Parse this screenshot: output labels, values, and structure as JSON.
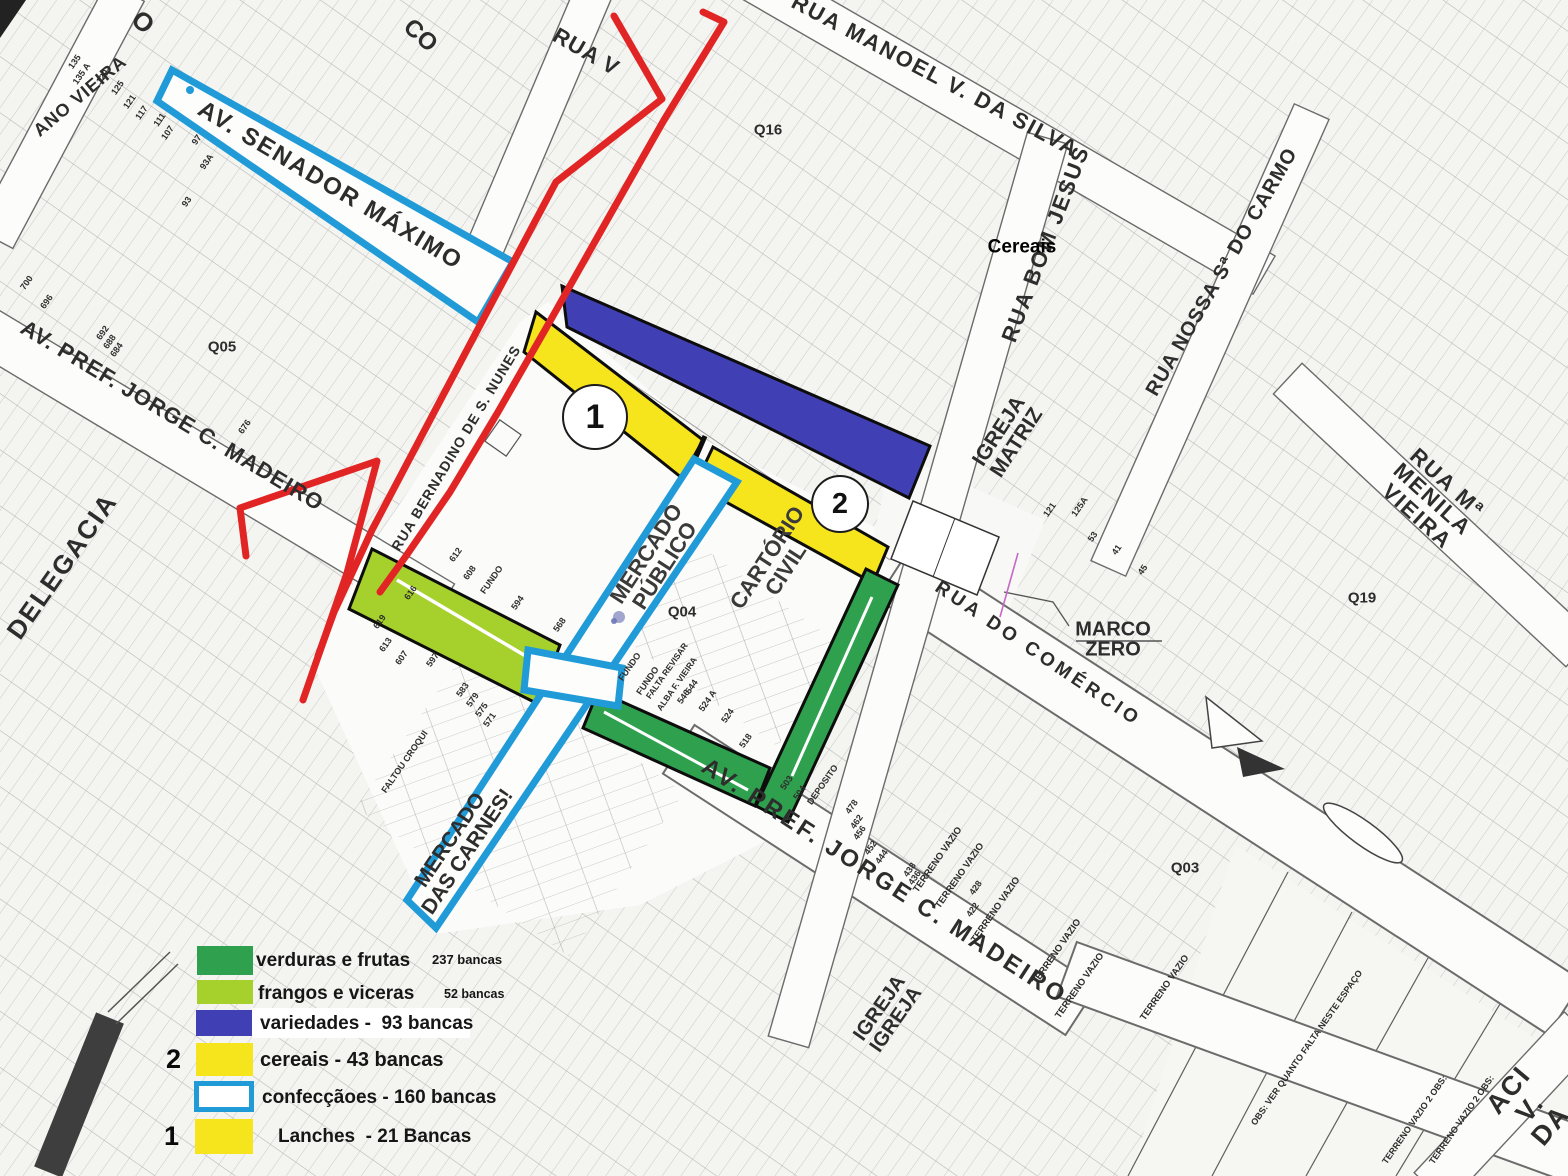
{
  "colors": {
    "green": "#2fa04e",
    "light_green": "#a6d02c",
    "blue": "#4040b4",
    "yellow": "#f6e41d",
    "cyan": "#209bd8",
    "red": "#e12525",
    "magenta": "#c667c6",
    "paper": "#f4f4f1",
    "street": "#fcfcfa",
    "ink": "#2d2d2d",
    "dark_bar": "#3e3e3e"
  },
  "legend": {
    "marker_2": "2",
    "marker_1": "1",
    "items": [
      {
        "label": "verduras e frutas",
        "count": "237 bancas"
      },
      {
        "label": "frangos e viceras",
        "count": "52 bancas"
      },
      {
        "label": "variedades -  93 bancas",
        "count": ""
      },
      {
        "label": "cereais - 43 bancas",
        "count": ""
      },
      {
        "label": "confecçãoes - 160 bancas",
        "count": ""
      },
      {
        "label": "Lanches  - 21 Bancas",
        "count": ""
      }
    ]
  },
  "map": {
    "markers": {
      "circle_1": "1",
      "circle_2": "2"
    },
    "street_labels": [
      {
        "name": "street-label-senador-maximo",
        "t": "AV. SENADOR MÁXIMO",
        "x": 330,
        "y": 186,
        "rot": 31,
        "size": 24,
        "ls": 2
      },
      {
        "name": "street-label-manoel-silva",
        "t": "RUA MANOEL V. DA SILVA",
        "x": 935,
        "y": 76,
        "rot": 28,
        "size": 22,
        "ls": 2
      },
      {
        "name": "street-label-madeiro-upper",
        "t": "AV. PREF. JORGE C. MADEIRO",
        "x": 172,
        "y": 416,
        "rot": 31,
        "size": 22,
        "ls": 1
      },
      {
        "name": "street-label-bernardino",
        "t": "RUA BERNADINO DE S. NUNES",
        "x": 456,
        "y": 448,
        "rot": -59,
        "size": 14,
        "ls": 1
      },
      {
        "name": "street-label-bom-jesus",
        "t": "RUA BOM JESUS",
        "x": 1046,
        "y": 244,
        "rot": -69,
        "size": 22,
        "ls": 2
      },
      {
        "name": "street-label-carmo",
        "t": "RUA NOSSA Sª DO CARMO",
        "x": 1222,
        "y": 272,
        "rot": -60,
        "size": 20,
        "ls": 1
      },
      {
        "name": "street-label-menila-vieira",
        "t": "RUA Mª MENILA VIEIRA",
        "x": 1432,
        "y": 500,
        "rot": 42,
        "size": 22,
        "ls": 2
      },
      {
        "name": "street-label-comercio",
        "t": "RUA DO COMÉRCIO",
        "x": 1038,
        "y": 654,
        "rot": 34,
        "size": 19,
        "ls": 4
      },
      {
        "name": "street-label-madeiro-lower",
        "t": "AV. PREF. JORGE C. MADEIRO",
        "x": 884,
        "y": 882,
        "rot": 33,
        "size": 24,
        "ls": 3
      },
      {
        "name": "street-label-aci",
        "t": "ACI V. DA",
        "x": 1530,
        "y": 1108,
        "rot": -50,
        "size": 27,
        "ls": 2
      },
      {
        "name": "street-label-rua-v",
        "t": "RUA V",
        "x": 586,
        "y": 52,
        "rot": 30,
        "size": 22,
        "ls": 1
      },
      {
        "name": "street-label-ano-vieira",
        "t": "ANO VIEIRA",
        "x": 80,
        "y": 96,
        "rot": -40,
        "size": 18,
        "ls": 1
      },
      {
        "name": "street-label-co",
        "t": "CO",
        "x": 420,
        "y": 36,
        "rot": 42,
        "size": 24
      },
      {
        "name": "street-label-o-fragment",
        "t": "O",
        "x": 143,
        "y": 22,
        "rot": 42,
        "size": 26
      }
    ],
    "area_labels": [
      {
        "name": "area-label-delegacia",
        "t": "DELEGACIA",
        "x": 62,
        "y": 566,
        "rot": -55,
        "size": 26,
        "ls": 2
      },
      {
        "name": "area-label-igreja-matriz",
        "t": "IGREJA\nMATRIZ",
        "x": 1008,
        "y": 437,
        "rot": -57,
        "size": 21
      },
      {
        "name": "area-label-mercado-publico",
        "t": "MERCADO\nPÚBLICO",
        "x": 656,
        "y": 560,
        "rot": -57,
        "size": 22,
        "color": "#3a3a3a"
      },
      {
        "name": "area-label-cartorio-civil",
        "t": "CARTÓRIO\nCIVIL",
        "x": 777,
        "y": 564,
        "rot": -57,
        "size": 22,
        "color": "#3a3a3a"
      },
      {
        "name": "area-label-mercado-carnes",
        "t": "MERCADO\nDAS CARNES!",
        "x": 459,
        "y": 846,
        "rot": -56,
        "size": 21
      },
      {
        "name": "area-label-marco-zero",
        "t": "MARCO\nZERO",
        "x": 1113,
        "y": 640,
        "rot": 0,
        "size": 20
      },
      {
        "name": "area-label-igreja-igreja",
        "t": "IGREJA\nIGREJA",
        "x": 888,
        "y": 1014,
        "rot": -55,
        "size": 20
      },
      {
        "name": "area-label-cereais",
        "t": "Cereais",
        "x": 1022,
        "y": 247,
        "rot": 0,
        "size": 19,
        "color": "#000"
      }
    ],
    "quad_labels": [
      {
        "name": "quad-label-q05",
        "t": "Q05",
        "x": 222,
        "y": 347
      },
      {
        "name": "quad-label-q16",
        "t": "Q16",
        "x": 768,
        "y": 130
      },
      {
        "name": "quad-label-q04",
        "t": "Q04",
        "x": 682,
        "y": 612
      },
      {
        "name": "quad-label-q19",
        "t": "Q19",
        "x": 1362,
        "y": 598
      },
      {
        "name": "quad-label-q03",
        "t": "Q03",
        "x": 1185,
        "y": 868
      }
    ],
    "small_labels": [
      {
        "name": "note-terreno-vazio",
        "t": "TERRENO VAZIO",
        "x": 938,
        "y": 860,
        "rot": -55,
        "size": 9.5
      },
      {
        "name": "note-terreno-vazio",
        "t": "TERRENO VAZIO",
        "x": 960,
        "y": 876,
        "rot": -55,
        "size": 9.5
      },
      {
        "name": "note-terreno-vazio",
        "t": "TERRENO VAZIO",
        "x": 996,
        "y": 910,
        "rot": -55,
        "size": 9.5
      },
      {
        "name": "note-terreno-vazio",
        "t": "TERRENO VAZIO",
        "x": 1057,
        "y": 952,
        "rot": -55,
        "size": 9.5
      },
      {
        "name": "note-terreno-vazio",
        "t": "TERRENO VAZIO",
        "x": 1080,
        "y": 986,
        "rot": -55,
        "size": 9.5
      },
      {
        "name": "note-terreno-vazio",
        "t": "TERRENO VAZIO",
        "x": 1165,
        "y": 988,
        "rot": -55,
        "size": 9.5
      },
      {
        "name": "note-terreno-vazio-obs",
        "t": "TERRENO VAZIO 2 OBS:",
        "x": 1415,
        "y": 1120,
        "rot": -55,
        "size": 9
      },
      {
        "name": "note-terreno-vazio-obs",
        "t": "TERRENO VAZIO 2 OBS:",
        "x": 1462,
        "y": 1120,
        "rot": -55,
        "size": 9
      },
      {
        "name": "note-obs-espaco",
        "t": "OBS: VER QUANTO FALTA NESTE ESPAÇO",
        "x": 1307,
        "y": 1048,
        "rot": -55,
        "size": 9
      },
      {
        "name": "note-fundo",
        "t": "FUNDO",
        "x": 492,
        "y": 580,
        "rot": -55,
        "size": 9
      },
      {
        "name": "note-fundo",
        "t": "FUNDO",
        "x": 630,
        "y": 667,
        "rot": -55,
        "size": 9
      },
      {
        "name": "note-fundo",
        "t": "FUNDO",
        "x": 648,
        "y": 681,
        "rot": -55,
        "size": 9
      },
      {
        "name": "note-falta-revisar",
        "t": "FALTA REVISAR",
        "x": 667,
        "y": 671,
        "rot": -55,
        "size": 8.5
      },
      {
        "name": "note-alba-vieira",
        "t": "ALBA F. VIEIRA",
        "x": 677,
        "y": 684,
        "rot": -55,
        "size": 8.5
      },
      {
        "name": "note-faltou-croqui",
        "t": "FALTOU CROQUI",
        "x": 405,
        "y": 762,
        "rot": -55,
        "size": 9
      },
      {
        "name": "note-deposito",
        "t": "DEPOSITO",
        "x": 823,
        "y": 785,
        "rot": -55,
        "size": 9
      }
    ],
    "parcel_numbers": [
      {
        "t": "135",
        "x": 75,
        "y": 62
      },
      {
        "t": "135 A",
        "x": 82,
        "y": 74
      },
      {
        "t": "129",
        "x": 103,
        "y": 77
      },
      {
        "t": "125",
        "x": 118,
        "y": 88
      },
      {
        "t": "121",
        "x": 130,
        "y": 102
      },
      {
        "t": "117",
        "x": 142,
        "y": 113
      },
      {
        "t": "111",
        "x": 160,
        "y": 120
      },
      {
        "t": "107",
        "x": 168,
        "y": 133
      },
      {
        "t": "97",
        "x": 197,
        "y": 140
      },
      {
        "t": "93A",
        "x": 207,
        "y": 162
      },
      {
        "t": "93",
        "x": 187,
        "y": 202
      },
      {
        "t": "700",
        "x": 27,
        "y": 283
      },
      {
        "t": "696",
        "x": 47,
        "y": 302
      },
      {
        "t": "692",
        "x": 103,
        "y": 333
      },
      {
        "t": "688",
        "x": 110,
        "y": 342
      },
      {
        "t": "684",
        "x": 117,
        "y": 350
      },
      {
        "t": "676",
        "x": 245,
        "y": 427
      },
      {
        "t": "619",
        "x": 380,
        "y": 622
      },
      {
        "t": "613",
        "x": 386,
        "y": 645
      },
      {
        "t": "607",
        "x": 402,
        "y": 658
      },
      {
        "t": "597",
        "x": 433,
        "y": 660
      },
      {
        "t": "583",
        "x": 463,
        "y": 690
      },
      {
        "t": "579",
        "x": 473,
        "y": 700
      },
      {
        "t": "575",
        "x": 482,
        "y": 710
      },
      {
        "t": "571",
        "x": 490,
        "y": 720
      },
      {
        "t": "616",
        "x": 411,
        "y": 593
      },
      {
        "t": "612",
        "x": 456,
        "y": 555
      },
      {
        "t": "608",
        "x": 470,
        "y": 573
      },
      {
        "t": "594",
        "x": 518,
        "y": 603
      },
      {
        "t": "568",
        "x": 560,
        "y": 625
      },
      {
        "t": "544",
        "x": 692,
        "y": 687
      },
      {
        "t": "546",
        "x": 684,
        "y": 697
      },
      {
        "t": "524 A",
        "x": 708,
        "y": 701
      },
      {
        "t": "524",
        "x": 728,
        "y": 716
      },
      {
        "t": "518",
        "x": 746,
        "y": 741
      },
      {
        "t": "503",
        "x": 787,
        "y": 783
      },
      {
        "t": "504",
        "x": 800,
        "y": 793
      },
      {
        "t": "478",
        "x": 852,
        "y": 807
      },
      {
        "t": "462",
        "x": 857,
        "y": 822
      },
      {
        "t": "456",
        "x": 860,
        "y": 833
      },
      {
        "t": "452",
        "x": 871,
        "y": 848
      },
      {
        "t": "444",
        "x": 882,
        "y": 857
      },
      {
        "t": "438",
        "x": 910,
        "y": 870
      },
      {
        "t": "436",
        "x": 915,
        "y": 878
      },
      {
        "t": "428",
        "x": 976,
        "y": 888
      },
      {
        "t": "422",
        "x": 973,
        "y": 910
      },
      {
        "t": "121",
        "x": 1050,
        "y": 510
      },
      {
        "t": "125A",
        "x": 1080,
        "y": 507
      },
      {
        "t": "53",
        "x": 1093,
        "y": 537
      },
      {
        "t": "41",
        "x": 1117,
        "y": 550
      },
      {
        "t": "45",
        "x": 1143,
        "y": 570
      }
    ]
  }
}
